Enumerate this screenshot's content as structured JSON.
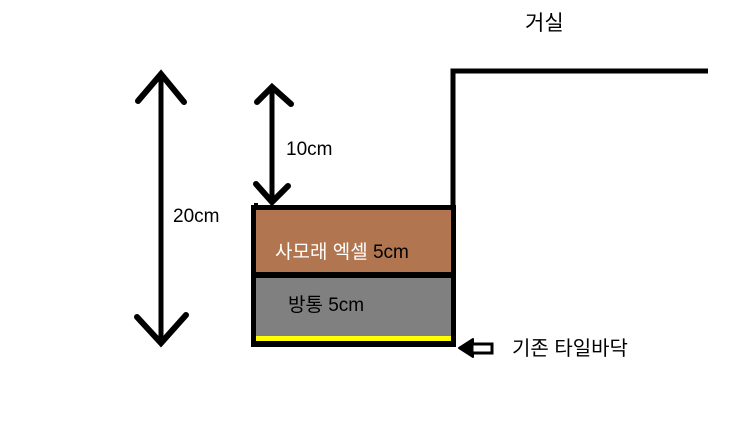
{
  "diagram": {
    "type": "floor-section-sketch",
    "room_label": "거실",
    "dimensions": {
      "total": "20cm",
      "gap": "10cm"
    },
    "layers": {
      "screed": {
        "name": "사모래 엑셀",
        "thickness": "5cm",
        "color": "#b1754f"
      },
      "concrete": {
        "label": "방통 5cm",
        "color": "#808080"
      },
      "tile": {
        "label": "기존 타일바닥",
        "color": "#ffff00"
      }
    },
    "colors": {
      "line": "#000000",
      "background": "#ffffff",
      "wave": "#ffffff"
    }
  }
}
